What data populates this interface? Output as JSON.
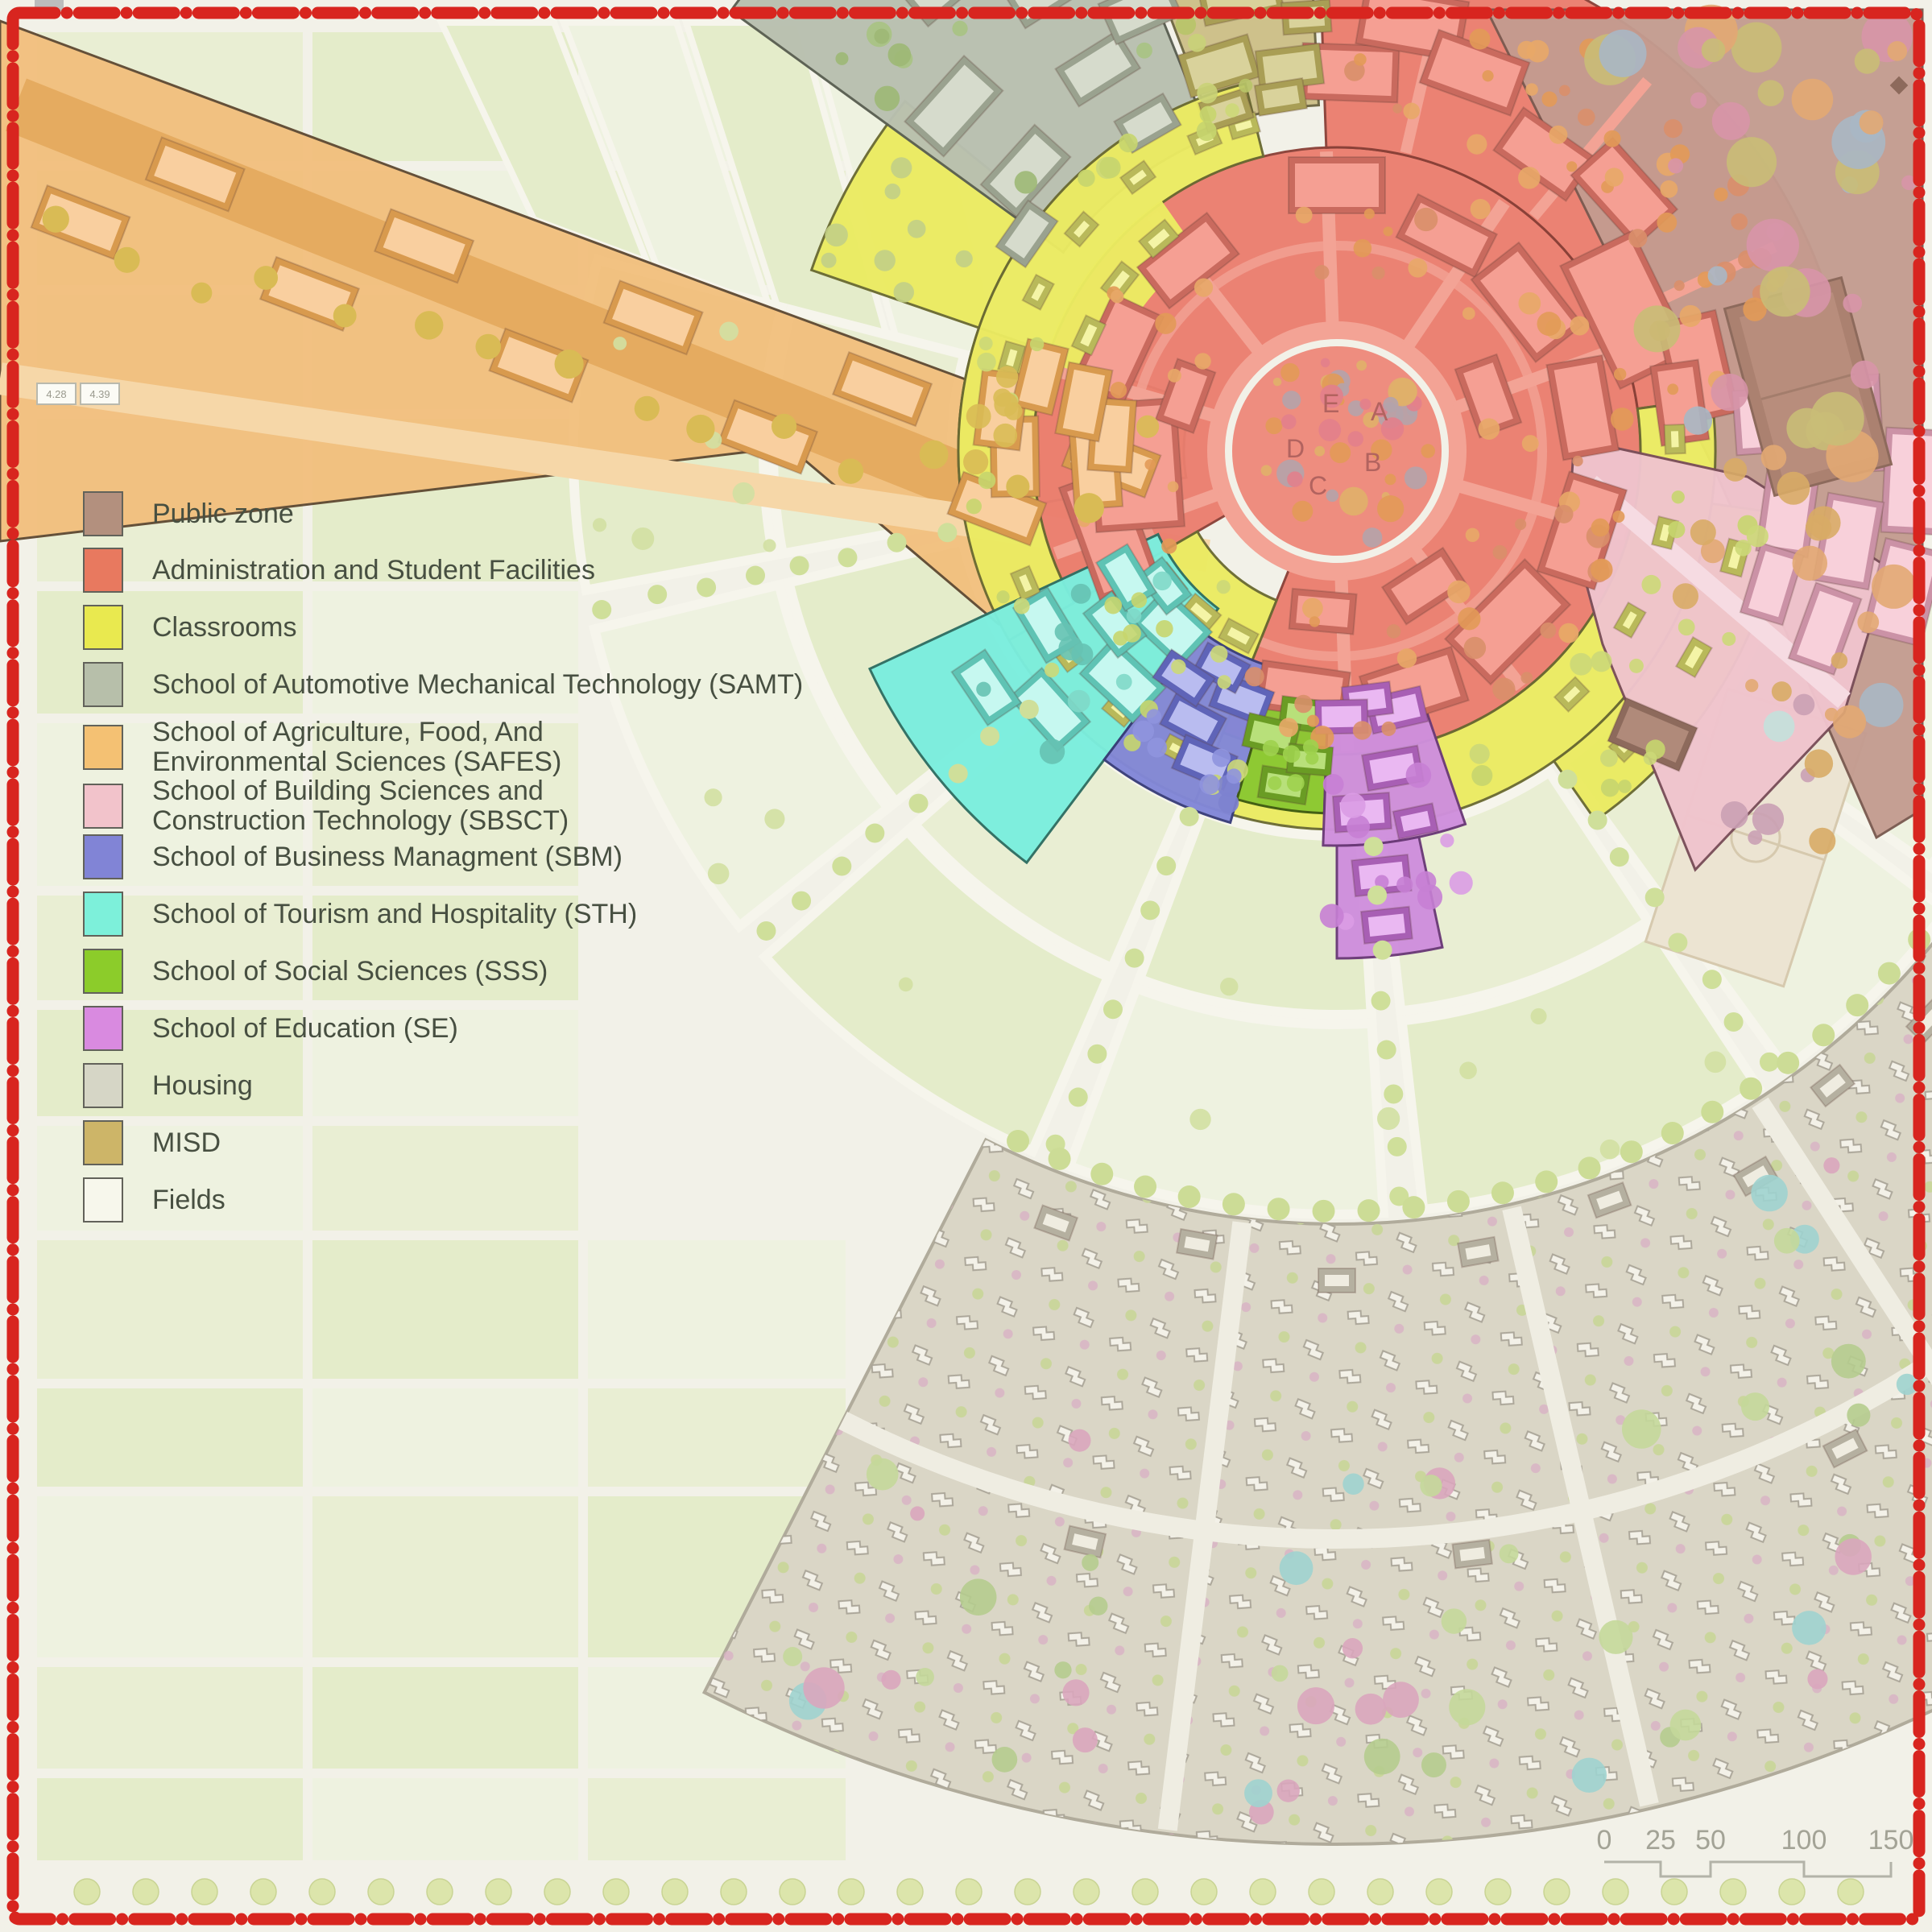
{
  "map": {
    "plaza_letters": [
      "E",
      "A",
      "B",
      "D",
      "C"
    ],
    "scale_bar": {
      "labels": [
        "0",
        "25",
        "50",
        "100",
        "150"
      ]
    },
    "parcel_labels": [
      "4.28",
      "4.39"
    ],
    "colors": {
      "background": "#f2f1e8",
      "field_green": "#e9eed3",
      "field_green_alt": "#e4ecca",
      "field_green_light": "#eef2e0",
      "road": "#f6f5ec",
      "border": "#d8251f",
      "public_zone": "#c49c90",
      "administration": "#eb7e6f",
      "plaza": "#ee8d7f",
      "classrooms": "#ebeb62",
      "samt": "#b9c0b0",
      "safes": "#f2c07e",
      "sbsct": "#f0c4cd",
      "sbm": "#8287d8",
      "sth": "#7beede",
      "sss": "#8cc832",
      "se": "#cf8fdd",
      "housing": "#dad6c6",
      "misd": "#cdc089",
      "fields_white": "#f7f7ee"
    }
  },
  "legend": {
    "items": [
      {
        "id": "public-zone",
        "label": "Public zone",
        "color": "#b3907e"
      },
      {
        "id": "administration",
        "label": "Administration and Student Facilities",
        "color": "#e8795f"
      },
      {
        "id": "classrooms",
        "label": "Classrooms",
        "color": "#e9e94f"
      },
      {
        "id": "samt",
        "label": "School of Automotive Mechanical Technology (SAMT)",
        "color": "#b7bfaa"
      },
      {
        "id": "safes",
        "label": "School of Agriculture, Food, And Environmental Sciences (SAFES)",
        "color": "#f4c173"
      },
      {
        "id": "sbsct",
        "label": "School of Building Sciences and Construction Technology (SBSCT)",
        "color": "#f2c3cb"
      },
      {
        "id": "sbm",
        "label": "School of Business Managment (SBM)",
        "color": "#8184d6"
      },
      {
        "id": "sth",
        "label": "School of Tourism and Hospitality (STH)",
        "color": "#7df0da"
      },
      {
        "id": "sss",
        "label": "School of Social Sciences (SSS)",
        "color": "#8ccc2a"
      },
      {
        "id": "se",
        "label": "School of Education (SE)",
        "color": "#d98ae0"
      },
      {
        "id": "housing",
        "label": "Housing",
        "color": "#d6d6c6"
      },
      {
        "id": "misd",
        "label": "MISD",
        "color": "#cdb568"
      },
      {
        "id": "fields",
        "label": "Fields",
        "color": "#f7f7ec"
      }
    ]
  }
}
